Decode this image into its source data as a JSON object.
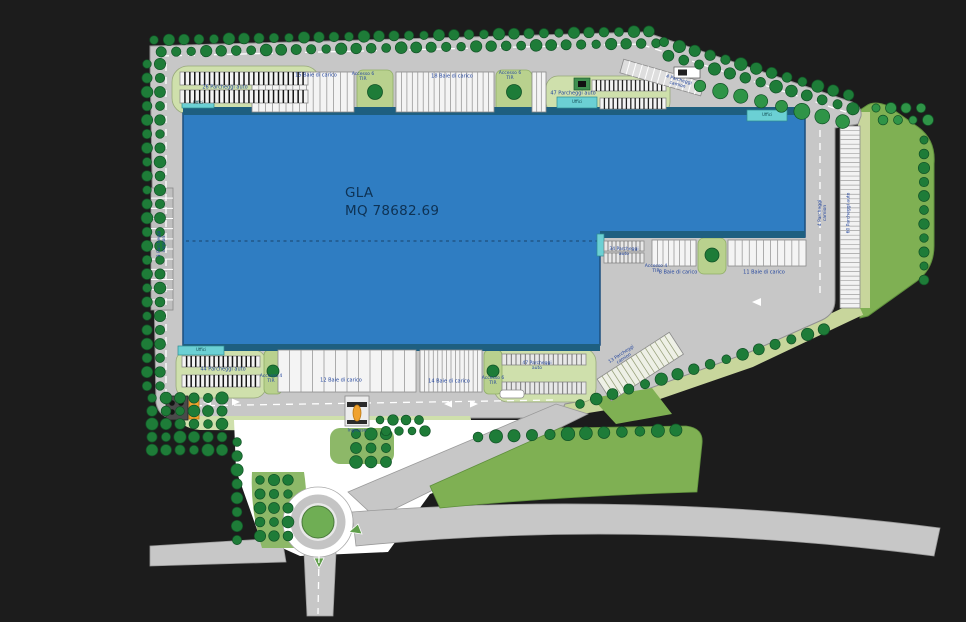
{
  "plan": {
    "building": {
      "name_line1": "GLA",
      "name_line2": "MQ 78682.69"
    },
    "labels": {
      "parking_26": "26 Parcheggi auto",
      "dock_15": "15 Baie di carico",
      "dock_18": "18 Baie di carico",
      "dock_12": "12 Baie di carico",
      "dock_14": "14 Baie di carico",
      "dock_8": "8 Baie di carico",
      "dock_11": "11 Baie di carico",
      "parking_47": "47 Parcheggi auto",
      "parking_44": "44 Parcheggi auto",
      "parking_34": "34 Parcheggi auto",
      "parking_60": "60 Parcheggi auto",
      "parking_4_camion": "4 Parcheggi camion",
      "parking_3_camion": "3 Parcheggi camion",
      "parking_13_camion": "13 Parcheggi camion",
      "access_6_tir": "Accesso 6 TIR",
      "access_4_tir": "Accesso 4 TIR",
      "ingresso": "Ingresso",
      "uffici": "Uffici"
    },
    "colors": {
      "background": "#1c1c1c",
      "building_blue": "#2f7dc2",
      "canopy_blue": "#1e5f80",
      "road_gray": "#c7c7c7",
      "landscape_green": "#7fb053",
      "tree_green": "#1e7c38",
      "verge_pale_green": "#cfe0ac",
      "office_cyan": "#6bd0d4",
      "barrier_orange": "#f0a22e",
      "label_blue": "#24469e"
    }
  }
}
